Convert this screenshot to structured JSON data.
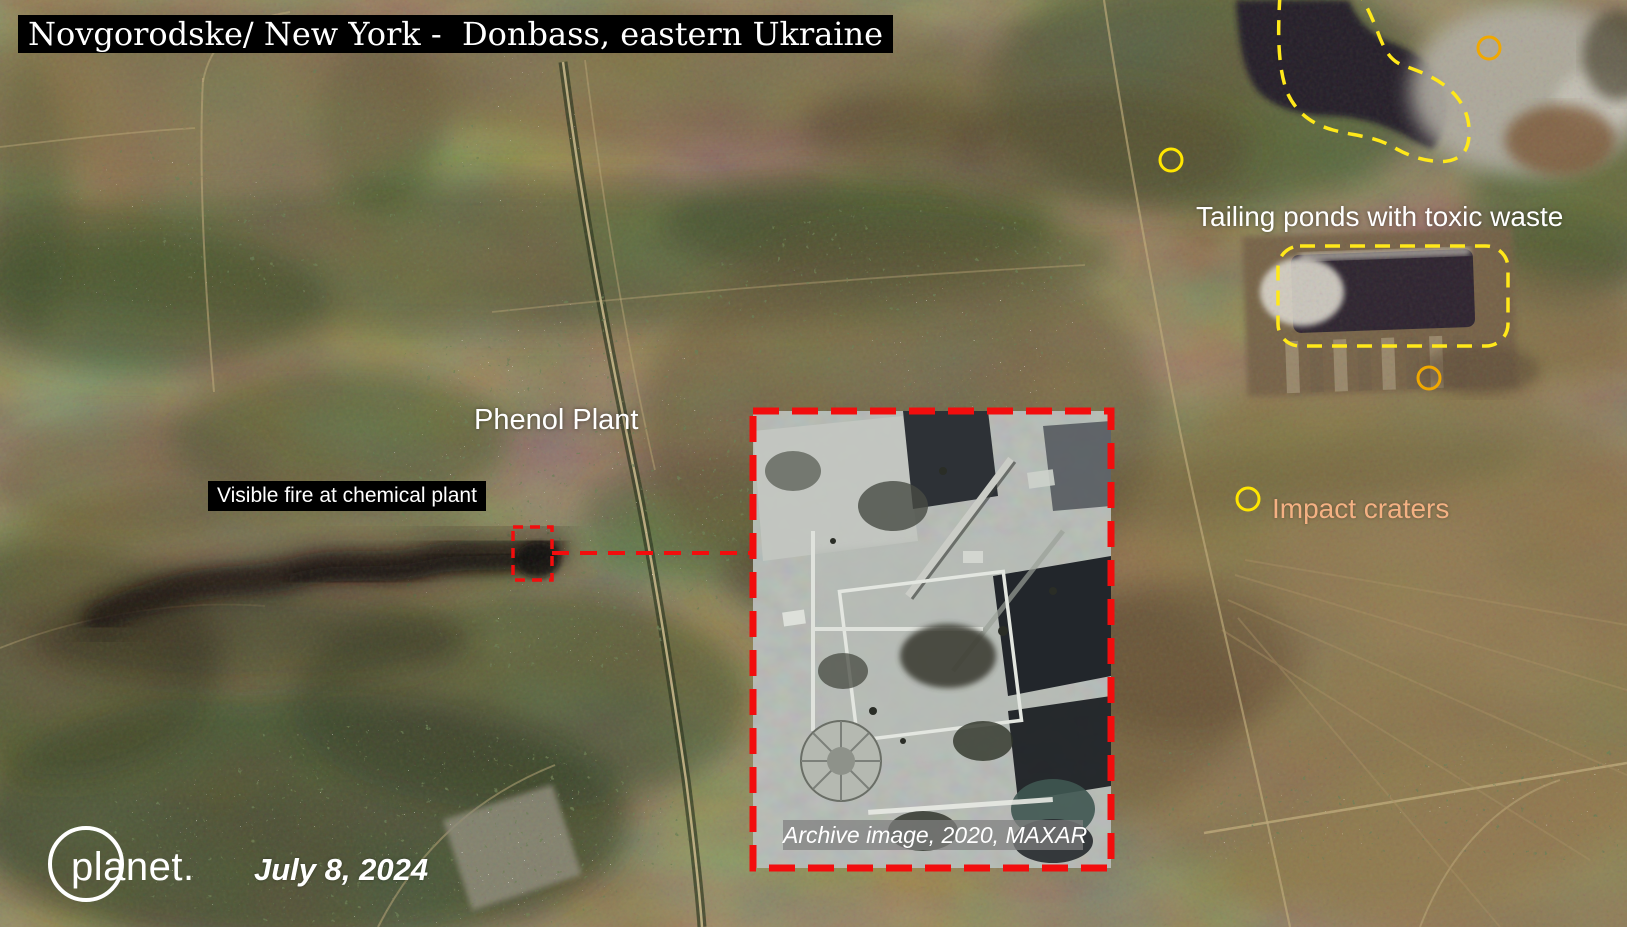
{
  "header": {
    "title": "Novgorodske/ New York -  Donbass, eastern Ukraine"
  },
  "map_labels": {
    "tailing_ponds": "Tailing ponds with toxic waste",
    "impact_craters": "Impact craters",
    "phenol_plant": "Phenol Plant",
    "visible_fire": "Visible fire at chemical plant"
  },
  "inset": {
    "caption": "Archive image, 2020, MAXAR"
  },
  "footer": {
    "logo": "planet.",
    "date": "July 8, 2024"
  },
  "colors": {
    "annotation_red": "#f20d0d",
    "annotation_yellow": "#ffe81a",
    "marker_gold": "#f0a800",
    "marker_yellow": "#ffe600",
    "impact_label_text": "#f4b183",
    "label_text": "#ffffff",
    "label_bg": "#000000",
    "logo_white": "#ffffff"
  }
}
